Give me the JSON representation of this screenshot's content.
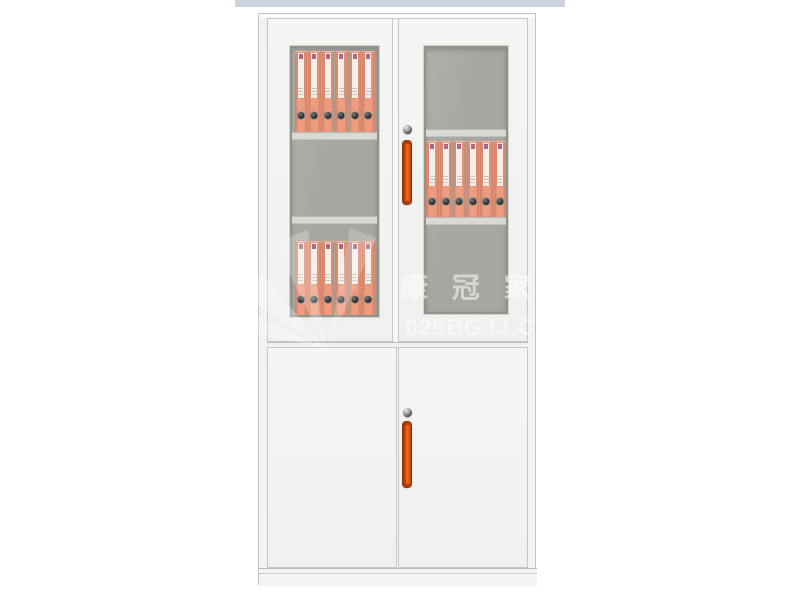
{
  "watermark": {
    "brand_cn": "康 冠 家 具",
    "brand_url": "025BGJJ.COM"
  },
  "colors": {
    "top-strip": "#cbd3dd",
    "door-face": "#f5f5f3",
    "door-border": "#c6c6c4",
    "glass-gray": "#a5a7a0",
    "glass-frame": "#93938b",
    "shelf": "#d8d8d4",
    "binder": "#ee9c80",
    "binder-edge": "#cf7a5e",
    "binder-label": "#f4efe9",
    "binder-mark": "#a34e71",
    "binder-hole": "#2d2d2f",
    "handle": "#e25210",
    "handle-dark": "#93350a",
    "lock-dark": "#3f3f41",
    "watermark": "#ffffff"
  },
  "cabinet": {
    "upper_section": {
      "left_door": {
        "glass": true,
        "rows": [
          {
            "position": "top",
            "binders": 6
          },
          {
            "position": "middle",
            "binders": 0
          },
          {
            "position": "bottom",
            "binders": 6
          }
        ]
      },
      "right_door": {
        "glass": true,
        "lock": true,
        "handle": true,
        "rows": [
          {
            "position": "top",
            "binders": 0
          },
          {
            "position": "middle",
            "binders": 6
          },
          {
            "position": "bottom",
            "binders": 0
          }
        ]
      }
    },
    "lower_section": {
      "left_door": {
        "glass": false
      },
      "right_door": {
        "glass": false,
        "lock": true,
        "handle": true
      }
    },
    "binder_total": 18
  }
}
